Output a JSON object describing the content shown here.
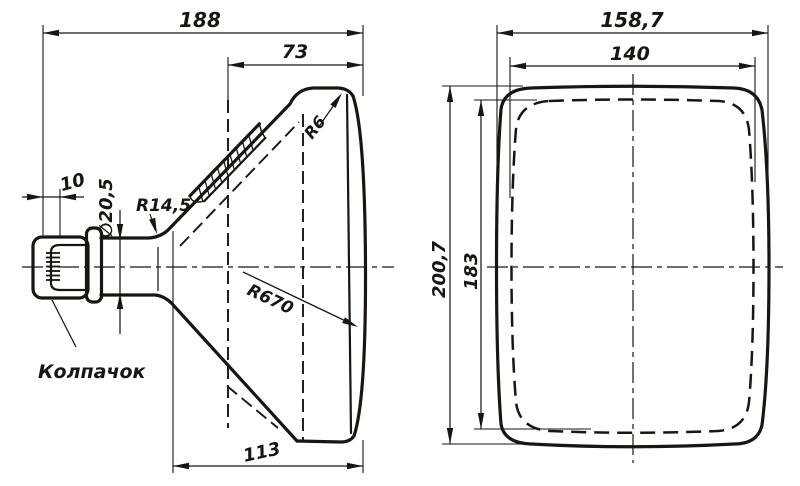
{
  "drawing": {
    "title": "CRT picture-tube outline drawing (two orthographic views)",
    "ink_color": "#191511",
    "background_color": "#ffffff",
    "side_view": {
      "dim_overall_length": "188",
      "dim_face_to_seal": "73",
      "dim_base_cap_length": "10",
      "dim_neck_diameter": "∅20,5",
      "radius_neck_to_cone": "R14,5",
      "radius_screen_corner": "R6",
      "radius_screen_face": "R670",
      "dim_cone_length": "113",
      "label_base_cap": "Колпачок"
    },
    "front_view": {
      "dim_bulb_width": "158,7",
      "dim_screen_width": "140",
      "dim_bulb_height": "200,7",
      "dim_screen_height": "183"
    }
  }
}
